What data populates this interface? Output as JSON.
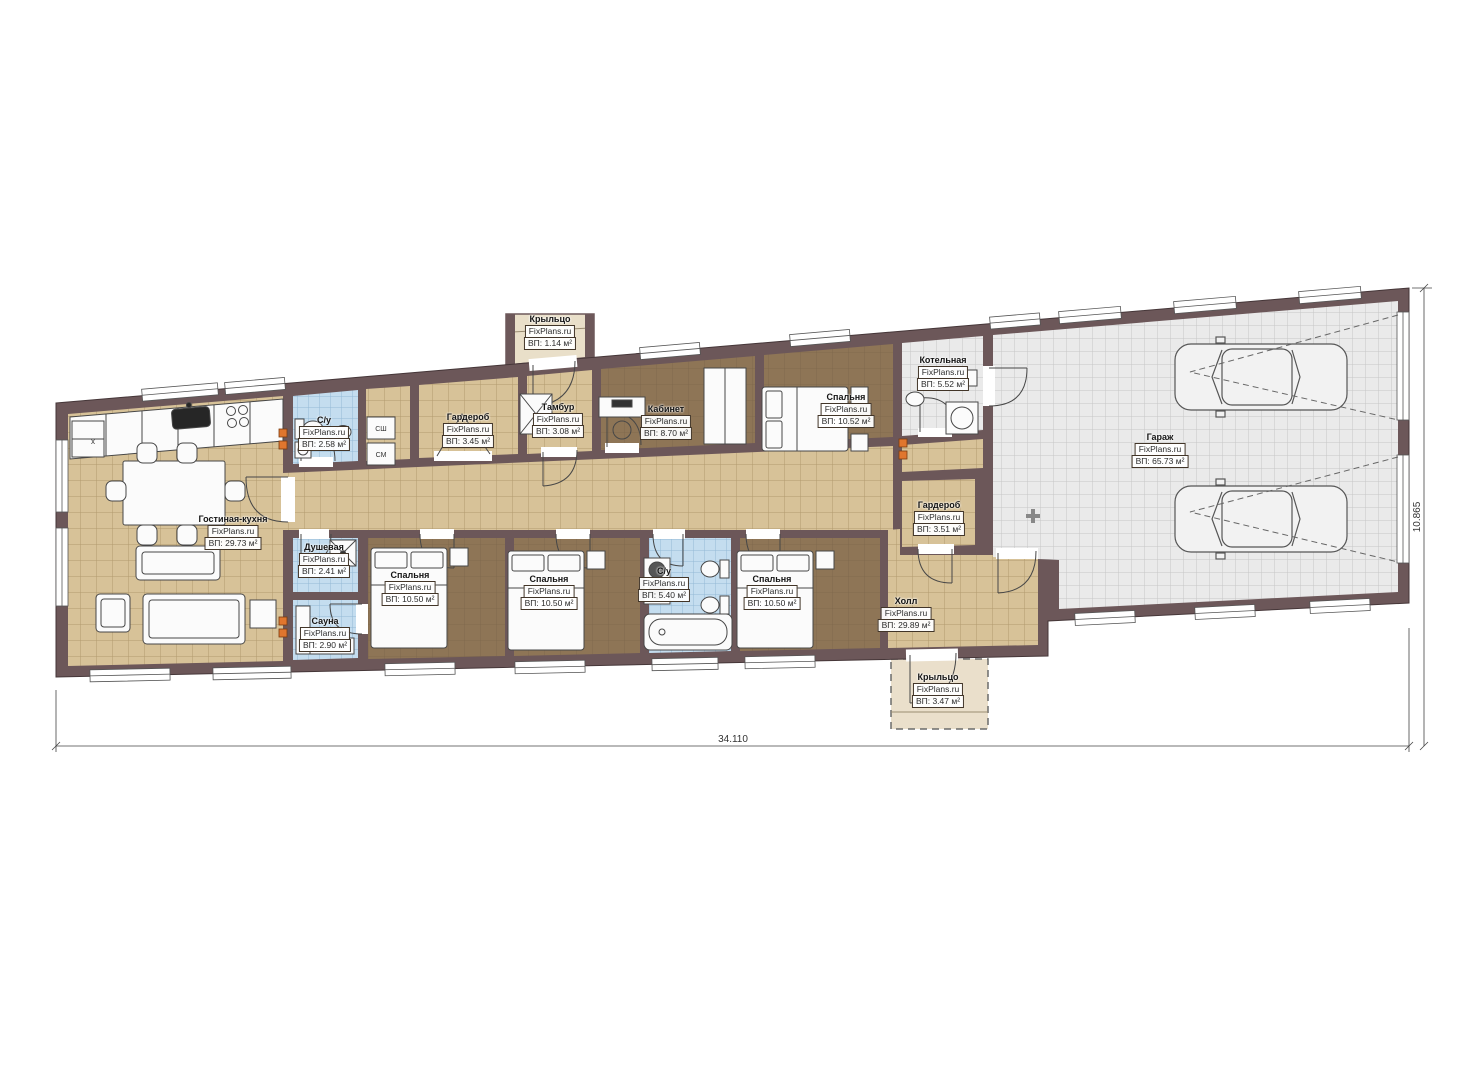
{
  "plan": {
    "watermark": "FixPlans.ru",
    "dimensions": {
      "width_label": "34.110",
      "height_label": "10.865"
    },
    "appliances": {
      "dryer": "СШ",
      "washer": "СМ",
      "kitchen_mark": "x"
    },
    "rooms": {
      "porch_top": {
        "name": "Крыльцо",
        "area": "ВП: 1.14 м²"
      },
      "su_top": {
        "name": "С/у",
        "area": "ВП: 2.58 м²"
      },
      "wardrobe_1": {
        "name": "Гардероб",
        "area": "ВП: 3.45 м²"
      },
      "tambur": {
        "name": "Тамбур",
        "area": "ВП: 3.08 м²"
      },
      "office": {
        "name": "Кабинет",
        "area": "ВП: 8.70 м²"
      },
      "bedroom_top": {
        "name": "Спальня",
        "area": "ВП: 10.52 м²"
      },
      "boiler": {
        "name": "Котельная",
        "area": "ВП: 5.52 м²"
      },
      "living": {
        "name": "Гостиная-кухня",
        "area": "ВП: 29.73 м²"
      },
      "shower": {
        "name": "Душевая",
        "area": "ВП: 2.41 м²"
      },
      "sauna": {
        "name": "Сауна",
        "area": "ВП: 2.90 м²"
      },
      "bedroom_1": {
        "name": "Спальня",
        "area": "ВП: 10.50 м²"
      },
      "bedroom_2": {
        "name": "Спальня",
        "area": "ВП: 10.50 м²"
      },
      "su_mid": {
        "name": "С/у",
        "area": "ВП: 5.40 м²"
      },
      "bedroom_3": {
        "name": "Спальня",
        "area": "ВП: 10.50 м²"
      },
      "wardrobe_2": {
        "name": "Гардероб",
        "area": "ВП: 3.51 м²"
      },
      "hall": {
        "name": "Холл",
        "area": "ВП: 29.89 м²"
      },
      "garage": {
        "name": "Гараж",
        "area": "ВП: 65.73 м²"
      },
      "porch_bottom": {
        "name": "Крыльцо",
        "area": "ВП: 3.47 м²"
      }
    }
  }
}
